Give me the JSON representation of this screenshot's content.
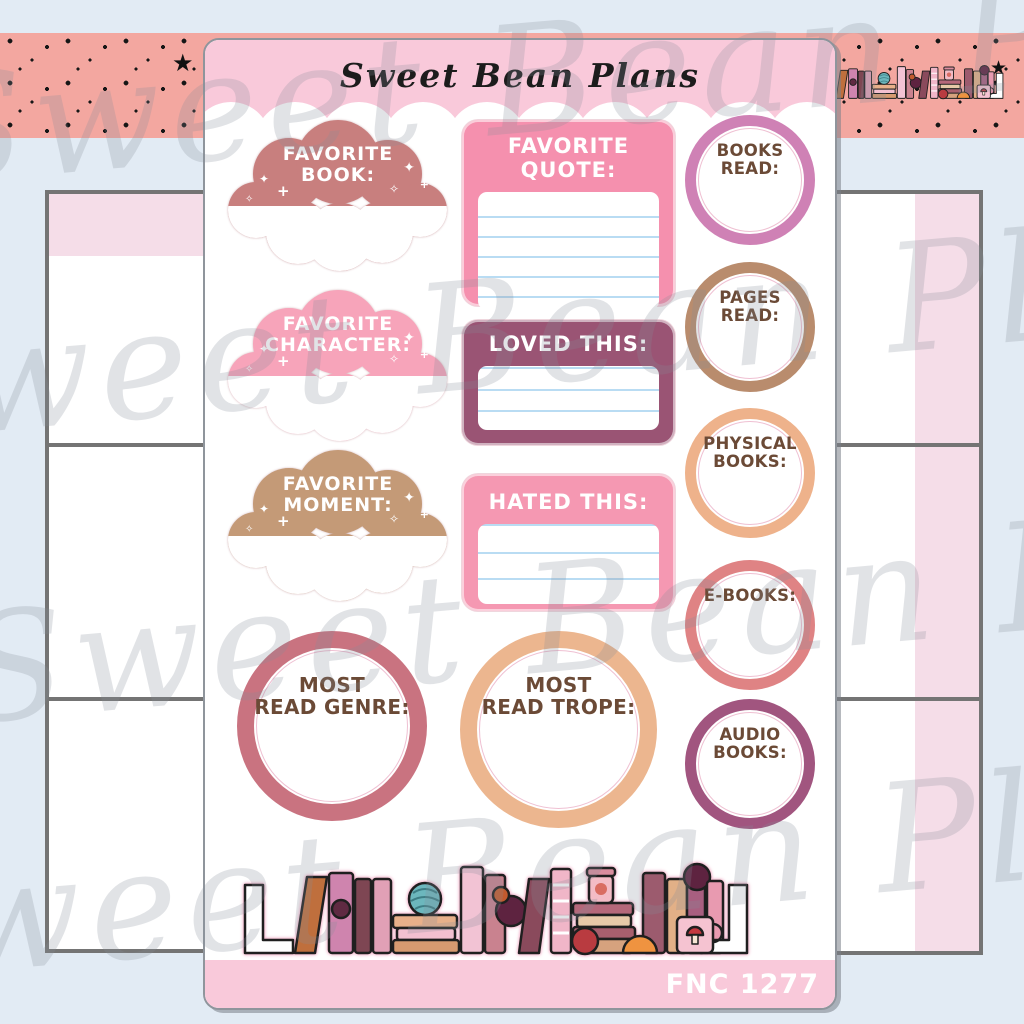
{
  "page": {
    "background_color": "#e2ebf4"
  },
  "watermark": {
    "text": "Sweet Bean Plans"
  },
  "banner": {
    "background_color": "#f3a7a0",
    "star_icon": "★"
  },
  "sheet": {
    "title": "Sweet Bean Plans",
    "sku": "FNC 1277",
    "header_color": "#f9c9da",
    "footer_color": "#f9c9da"
  },
  "sparkle_icons": {
    "four_point": "✦",
    "outline": "✧",
    "plus": "+"
  },
  "clouds": [
    {
      "line1": "FAVORITE",
      "line2": "BOOK:",
      "color": "#c87f7e"
    },
    {
      "line1": "FAVORITE",
      "line2": "CHARACTER:",
      "color": "#f7a4ba"
    },
    {
      "line1": "FAVORITE",
      "line2": "MOMENT:",
      "color": "#c49a77"
    }
  ],
  "boxes": [
    {
      "label": "FAVORITE QUOTE:",
      "color": "#f590ae",
      "ruled_lines": 6
    },
    {
      "label": "LOVED THIS:",
      "color": "#9a5474",
      "ruled_lines": 3
    },
    {
      "label": "HATED THIS:",
      "color": "#f598b2",
      "ruled_lines": 3
    }
  ],
  "tracker_circles": [
    {
      "line1": "BOOKS",
      "line2": "READ:",
      "ring_color": "#cf81b5"
    },
    {
      "line1": "PAGES",
      "line2": "READ:",
      "ring_color": "#b98c6d"
    },
    {
      "line1": "PHYSICAL",
      "line2": "BOOKS:",
      "ring_color": "#eeb28b"
    },
    {
      "line1": "E-BOOKS:",
      "line2": "",
      "ring_color": "#df8384"
    },
    {
      "line1": "AUDIO",
      "line2": "BOOKS:",
      "ring_color": "#a1557f"
    }
  ],
  "stat_circles": [
    {
      "line1": "MOST",
      "line2": "READ GENRE:",
      "ring_color": "#c97380"
    },
    {
      "line1": "MOST",
      "line2": "READ TROPE:",
      "ring_color": "#ecb68f"
    }
  ]
}
